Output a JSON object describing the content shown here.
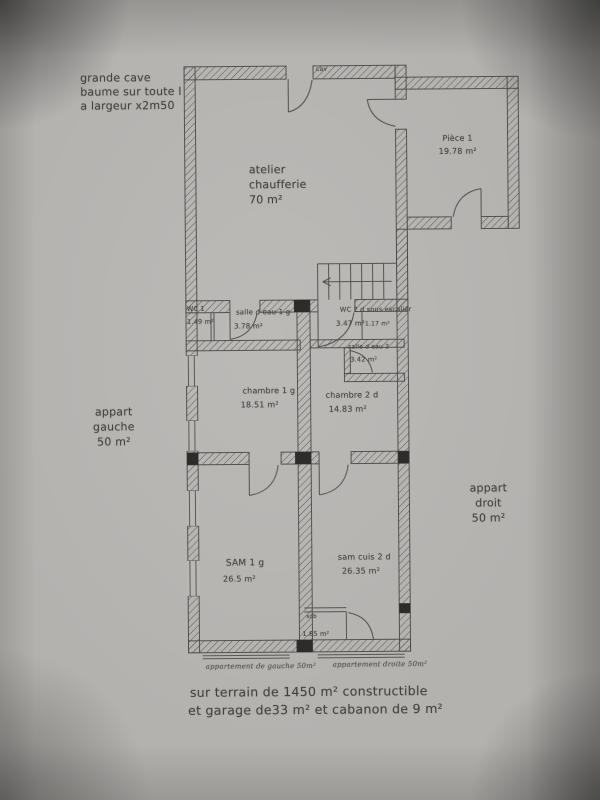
{
  "notes": {
    "cave": {
      "line1": "grande cave",
      "line2": "baume sur toute l",
      "line3": "a largeur x2m50"
    },
    "appart_gauche": {
      "line1": "appart",
      "line2": "gauche",
      "line3": "50 m²"
    },
    "appart_droit": {
      "line1": "appart",
      "line2": "droit",
      "line3": "50 m²"
    }
  },
  "rooms": {
    "cav_marker": "cav",
    "atelier": {
      "line1": "atelier",
      "line2": "chaufferie",
      "area": "70 m²"
    },
    "piece1": {
      "name": "Pièce 1",
      "area": "19.78 m²"
    },
    "wc1": {
      "name": "WC 1",
      "area": "1.49 m²"
    },
    "salle_eau_1": {
      "name": "salle d eau 1 g",
      "area": "3.78 m²"
    },
    "wc2": {
      "name": "WC 2 d sous escalier",
      "area": "3.47 m²"
    },
    "placard": {
      "area": "1.17 m²"
    },
    "salle_eau_2": {
      "name": "salle d eau 2",
      "area": "3.42 m²"
    },
    "chambre1": {
      "name": "chambre 1 g",
      "area": "18.51 m²"
    },
    "chambre2": {
      "name": "chambre 2 d",
      "area": "14.83 m²"
    },
    "sam1": {
      "name": "SAM 1 g",
      "area": "26.5 m²"
    },
    "sam_cuis_2": {
      "name": "sam cuis 2 d",
      "area": "26.35 m²"
    },
    "sdb": {
      "name": "sdb",
      "area": "1.85 m²"
    }
  },
  "captions": {
    "gauche": "appartement de gauche 50m²",
    "droite": "appartement droite 50m²"
  },
  "footer": {
    "line1": "sur terrain de 1450 m² constructible",
    "line2": "et garage de33 m² et cabanon de 9 m²"
  }
}
